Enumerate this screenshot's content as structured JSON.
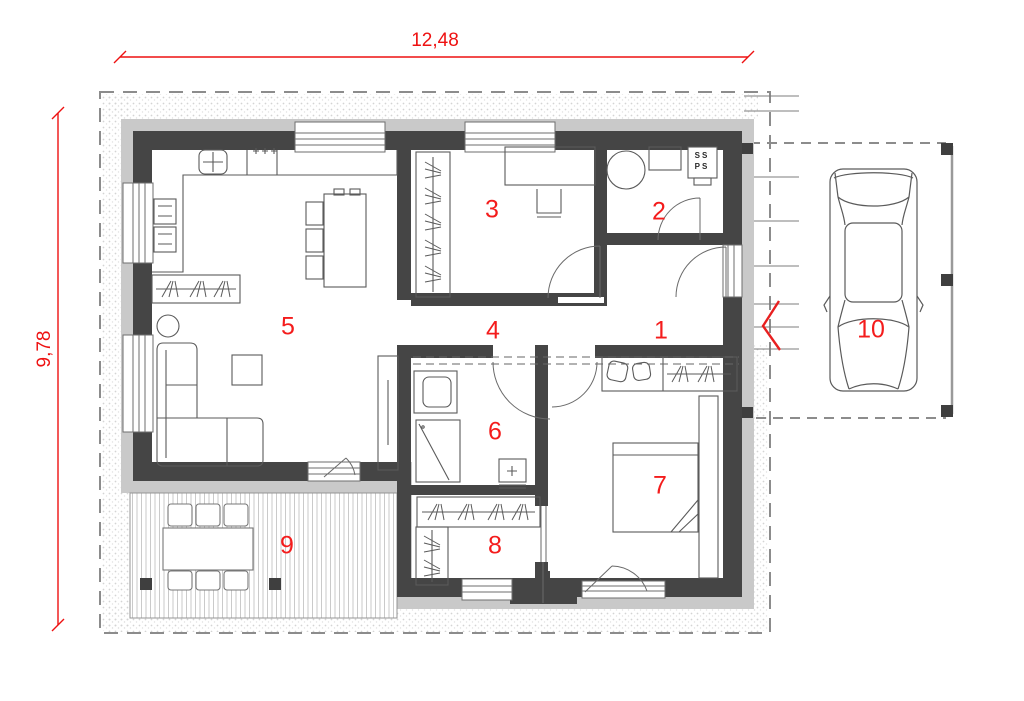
{
  "plan": {
    "dimensions": {
      "width": "12,48",
      "height": "9,78"
    },
    "rooms": [
      {
        "number": "1"
      },
      {
        "number": "2"
      },
      {
        "number": "3"
      },
      {
        "number": "4"
      },
      {
        "number": "5"
      },
      {
        "number": "6"
      },
      {
        "number": "7"
      },
      {
        "number": "8"
      },
      {
        "number": "9"
      },
      {
        "number": "10"
      }
    ],
    "shaft": {
      "line1": "SS",
      "line2": "PS"
    },
    "colors": {
      "annotation_red": "#f21515",
      "wall_dark": "#454545",
      "facade_gray": "#c9c9c9"
    },
    "icons": [
      "car-icon",
      "entrance-arrow-icon",
      "bed-icon",
      "bench-icon",
      "sofa-icon",
      "coffee-table-icon",
      "plant-icon",
      "tv-cabinet-icon",
      "dining-table-icon",
      "kitchen-counter-icon",
      "sink-icon",
      "cooktop-icon",
      "refrigerator-icon",
      "sideboard-icon",
      "wardrobe-icon",
      "desk-icon",
      "desk-chair-icon",
      "washing-machine-icon",
      "bathroom-counter-icon",
      "shaft-box-icon",
      "washbasin-icon",
      "shower-icon",
      "toilet-icon",
      "terrace-dining-set-icon"
    ]
  }
}
